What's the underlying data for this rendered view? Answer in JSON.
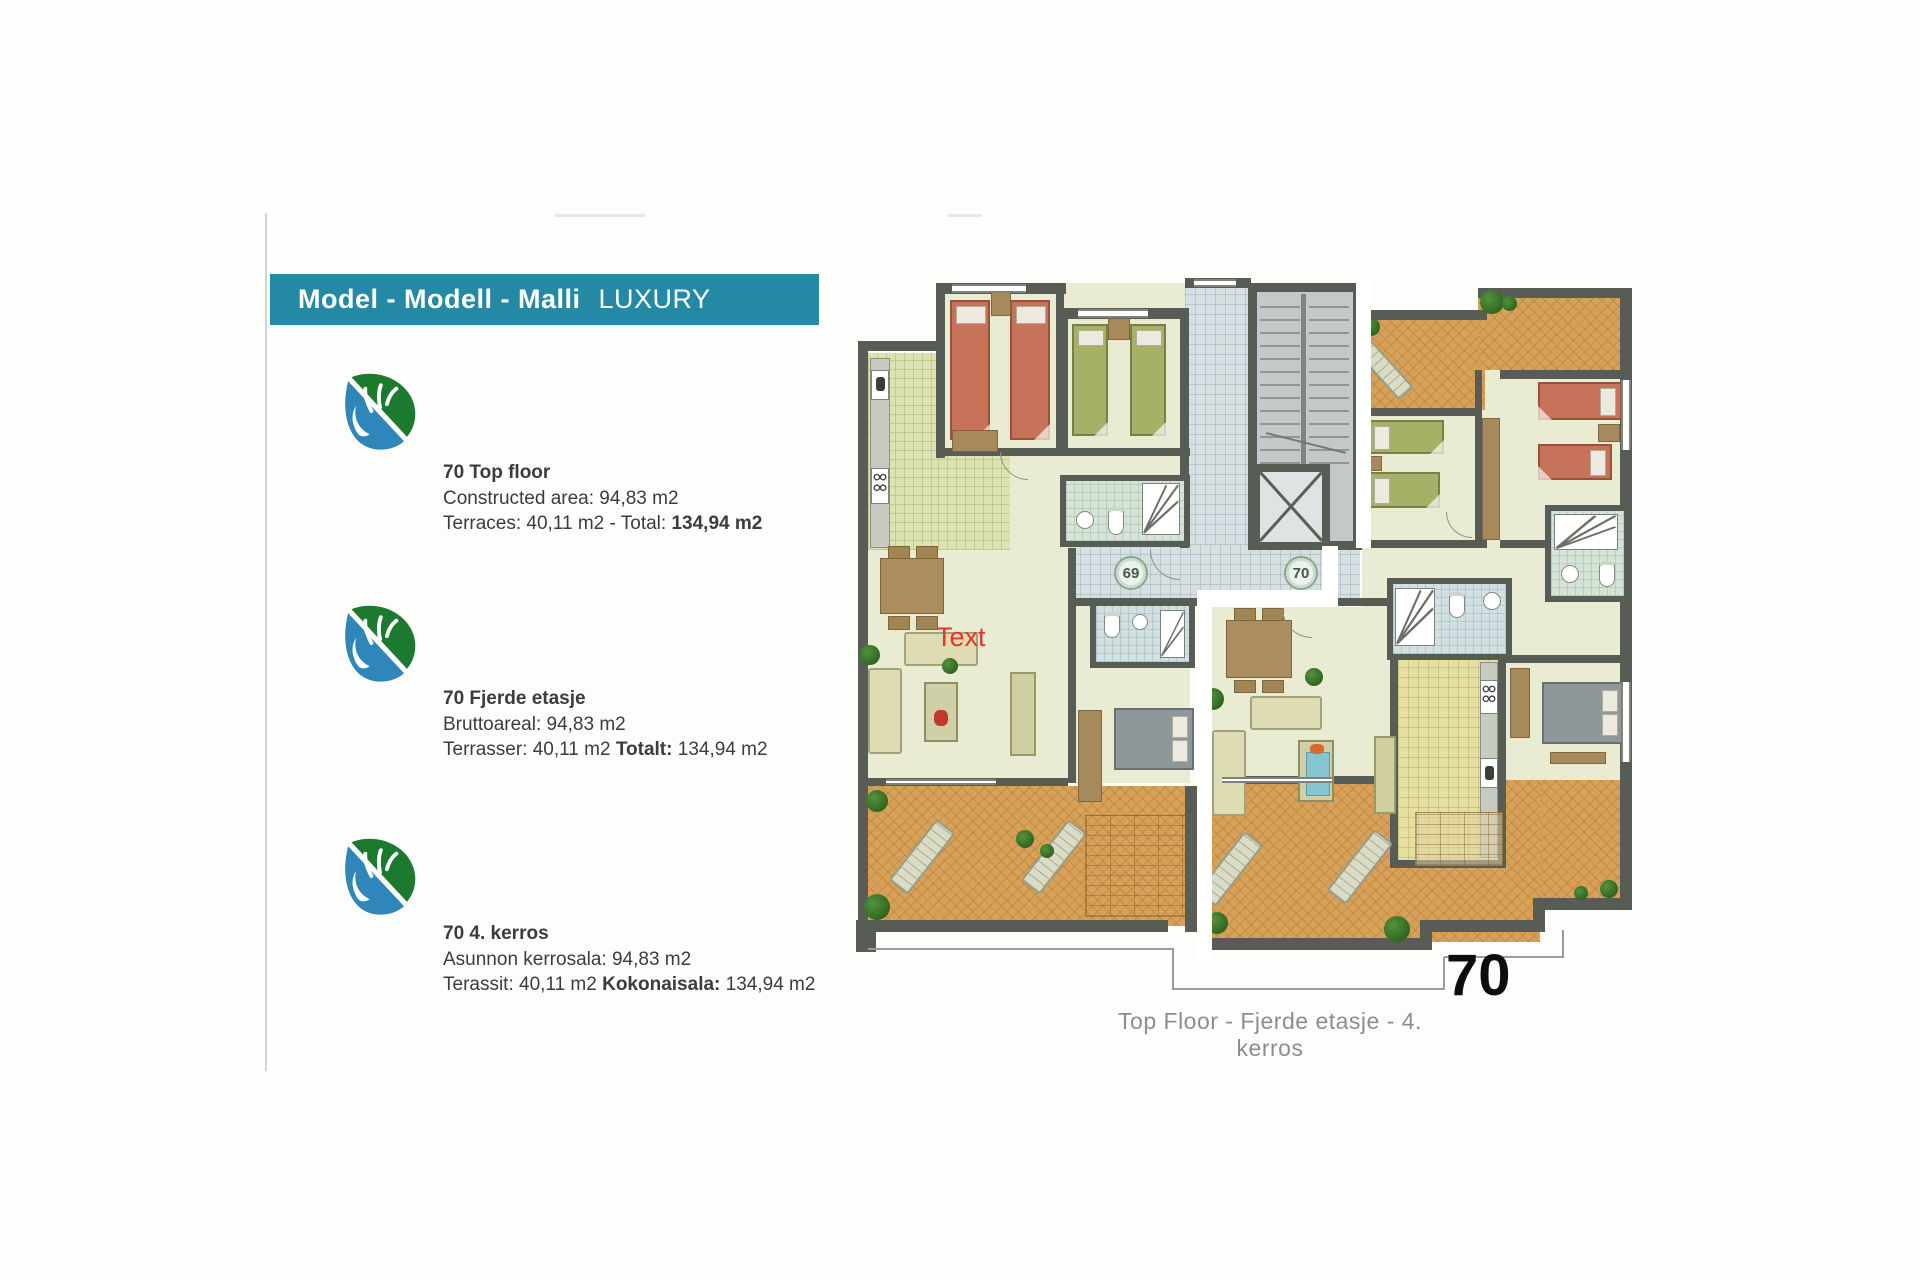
{
  "banner": {
    "models": "Model - Modell - Malli",
    "variant": "LUXURY"
  },
  "colors": {
    "banner_bg": "#2489a5",
    "annotation_red": "#e0372e",
    "wall": "#575c55",
    "terrace": "#d7a159"
  },
  "blocks": [
    {
      "title": "70 Top floor",
      "area": "Constructed area: 94,83 m2",
      "terrace_prefix": "Terraces: 40,11 m2 - Total: ",
      "terrace_bold": "134,94 m2",
      "terrace_suffix": ""
    },
    {
      "title": "70 Fjerde etasje",
      "area": "Bruttoareal: 94,83 m2",
      "terrace_prefix": "Terrasser: 40,11 m2 ",
      "terrace_bold": "Totalt:",
      "terrace_suffix": " 134,94 m2"
    },
    {
      "title": "70 4. kerros",
      "area": "Asunnon kerrosala: 94,83 m2",
      "terrace_prefix": "Terassit: 40,11 m2 ",
      "terrace_bold": "Kokonaisala:",
      "terrace_suffix": " 134,94 m2"
    }
  ],
  "plan": {
    "unit69_label": "69",
    "unit70_label": "70",
    "annotation": "Text",
    "big_number": "70",
    "caption": "Top Floor - Fjerde etasje - 4. kerros"
  }
}
